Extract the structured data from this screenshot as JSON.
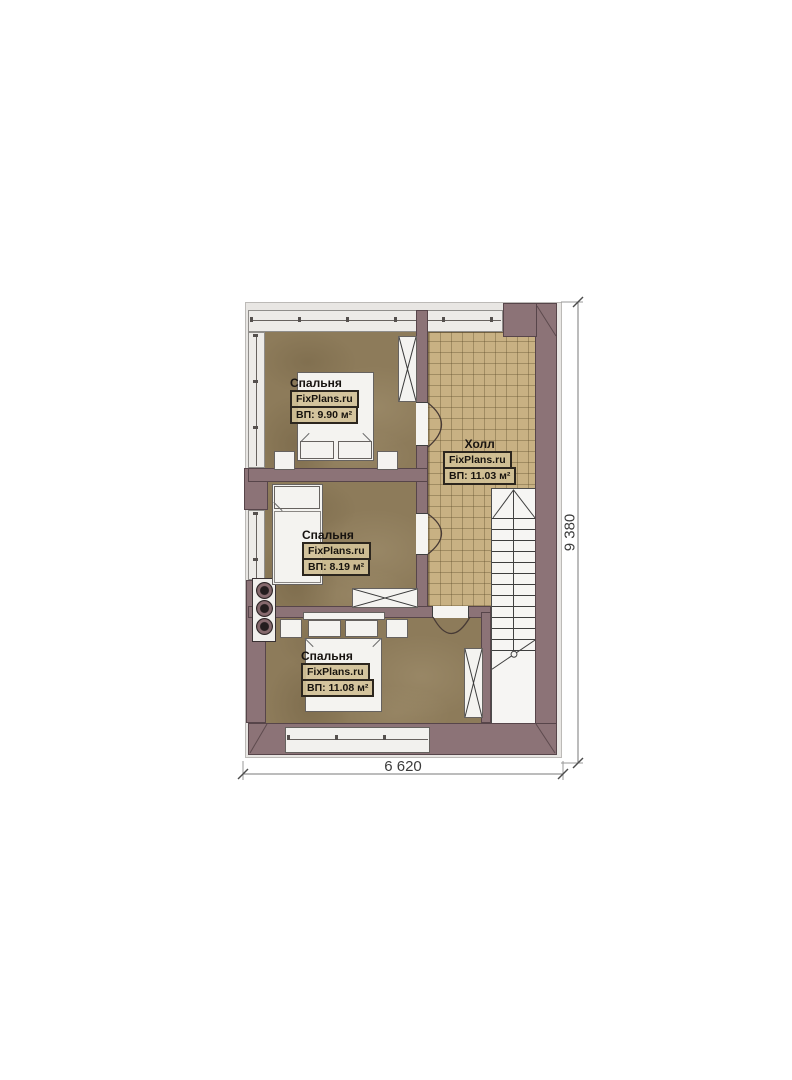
{
  "rooms": {
    "bedroom_top": {
      "name": "Спальня",
      "brand": "FixPlans.ru",
      "area": "ВП: 9.90 м²"
    },
    "bedroom_middle": {
      "name": "Спальня",
      "brand": "FixPlans.ru",
      "area": "ВП: 8.19 м²"
    },
    "bedroom_bottom": {
      "name": "Спальня",
      "brand": "FixPlans.ru",
      "area": "ВП: 11.08 м²"
    },
    "hall": {
      "name": "Холл",
      "brand": "FixPlans.ru",
      "area": "ВП: 11.03 м²"
    }
  },
  "dimensions": {
    "width": "6 620",
    "height": "9 380"
  },
  "colors": {
    "wall": "#8c7377",
    "bedroom_floor": "#8d7b5a",
    "hall_floor": "#c8b183",
    "furniture": "#f4f3f0",
    "wall_outline": "#57454a",
    "dimension_text": "#3c3c3c",
    "label_box_bg": "#d0c096",
    "label_border": "#2c261e"
  }
}
